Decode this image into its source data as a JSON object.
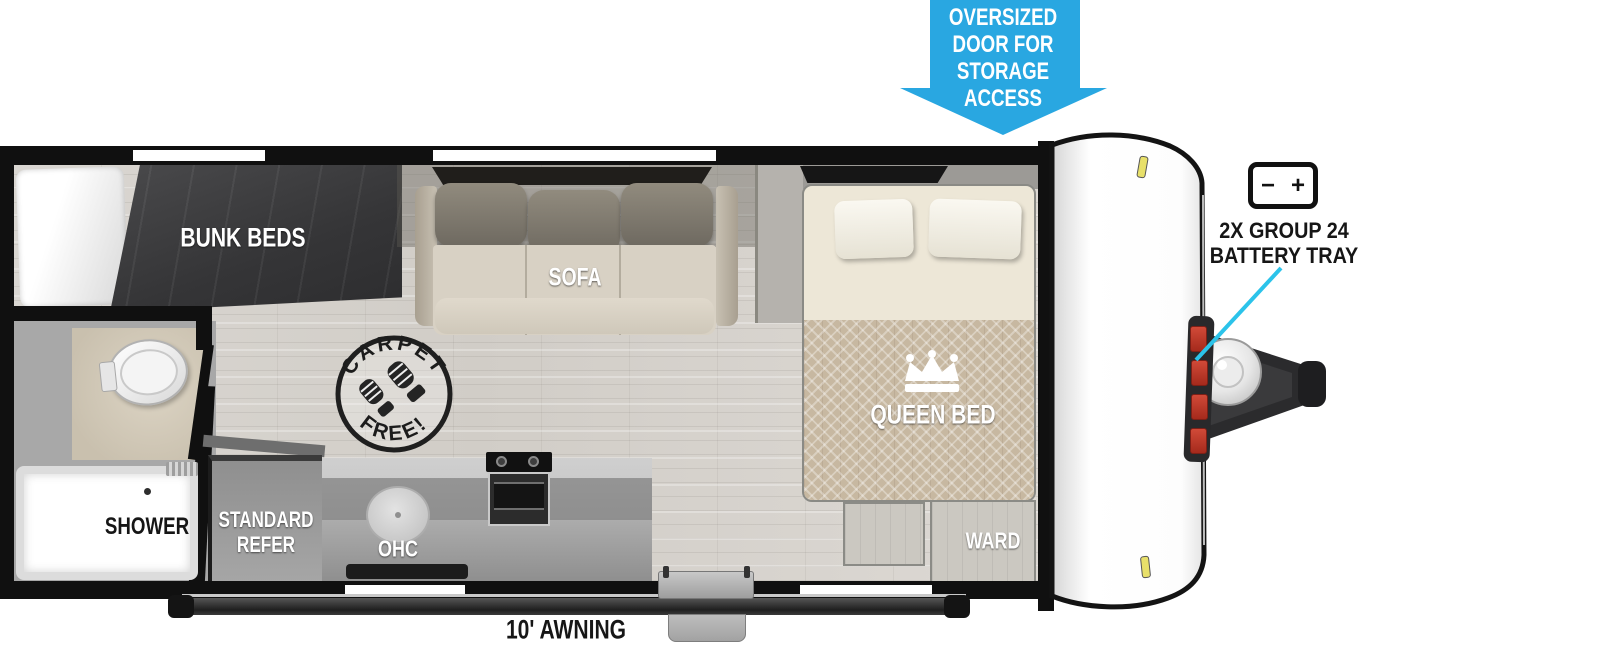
{
  "storage_callout": {
    "lines": [
      "OVERSIZED",
      "DOOR FOR",
      "STORAGE",
      "ACCESS"
    ],
    "arrow_color": "#29A7E1"
  },
  "battery_callout": {
    "minus": "−",
    "plus": "+",
    "line1": "2X GROUP 24",
    "line2": "BATTERY TRAY",
    "pointer_color": "#2BC3EA"
  },
  "rooms": {
    "bunk_beds": "BUNK BEDS",
    "sofa": "SOFA",
    "sofa_ohc": "OHC",
    "kitchen_ohc": "OHC",
    "queen_bed": "QUEEN BED",
    "ward": "WARD",
    "shower": "SHOWER",
    "refer_line1": "STANDARD",
    "refer_line2": "REFER"
  },
  "stamp": {
    "top": "CARPET",
    "bottom": "FREE!"
  },
  "awning": {
    "label": "10' AWNING"
  },
  "colors": {
    "wall": "#101010",
    "floor": "#D8D5D0",
    "accent_blue": "#29A7E1",
    "pointer_cyan": "#2BC3EA"
  }
}
